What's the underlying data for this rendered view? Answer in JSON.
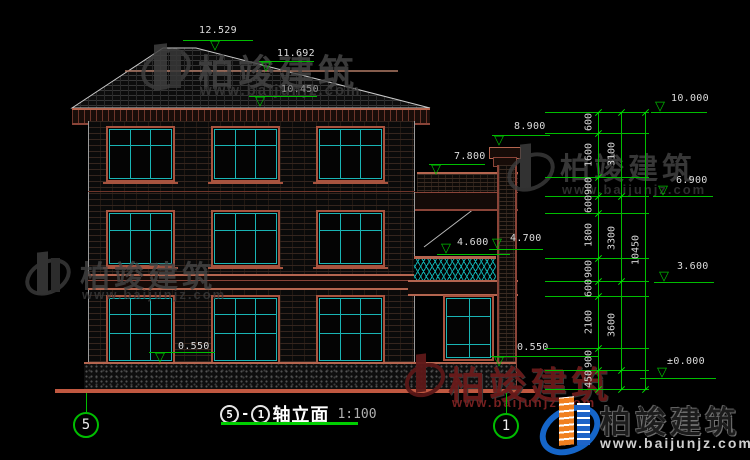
{
  "watermark": {
    "brand": "柏竣建筑",
    "url": "www.baijunjz.com"
  },
  "logo": {
    "brand": "柏竣建筑",
    "url": "www.baijunjz.com"
  },
  "title": {
    "axis_left": "5",
    "separator": "-",
    "axis_right": "1",
    "name": "轴立面",
    "scale": "1:100"
  },
  "axis_bubbles": {
    "left": "5",
    "right": "1"
  },
  "levels": {
    "ridge": "12.529",
    "upper_eave": "11.692",
    "main_eave": "10.450",
    "chimney_top": "8.900",
    "annex_roof": "7.800",
    "balcony_top": "4.700",
    "balcony_floor": "4.600",
    "plinth_left": "0.550",
    "plinth_right": "0.550",
    "right_top": "10.000",
    "right_f2": "6.900",
    "right_f1": "3.600",
    "right_ground": "±0.000"
  },
  "dims": {
    "inner": [
      "600",
      "1600",
      "900",
      "600",
      "1800",
      "900",
      "600",
      "2100",
      "900",
      "450"
    ],
    "middle": [
      "3100",
      "3300",
      "3600"
    ],
    "overall": "10450"
  }
}
